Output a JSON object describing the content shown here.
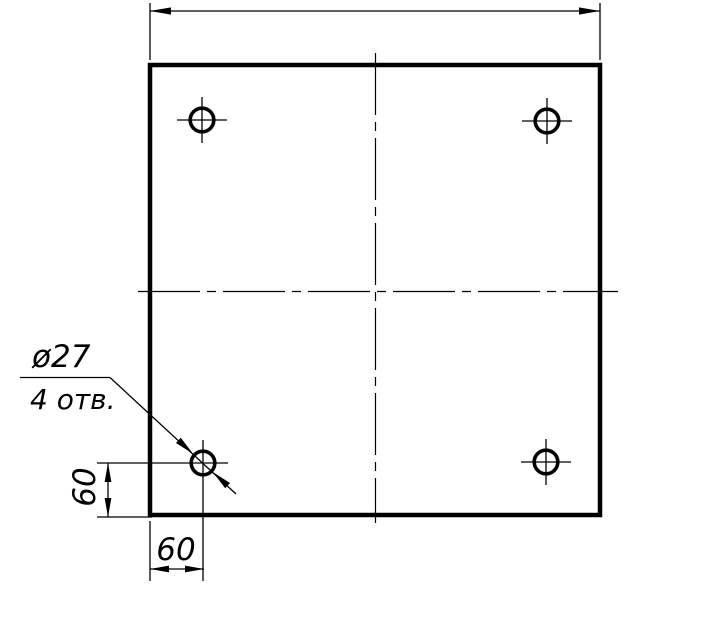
{
  "colors": {
    "line": "#000000",
    "background": "#ffffff"
  },
  "callout": {
    "diameter_label": "ø27",
    "count_label": "4 отв."
  },
  "dimensions": {
    "left_vertical": {
      "value": "60"
    },
    "bottom_horizontal": {
      "value": "60"
    }
  },
  "holes": {
    "count": 4,
    "diameter": 27
  }
}
